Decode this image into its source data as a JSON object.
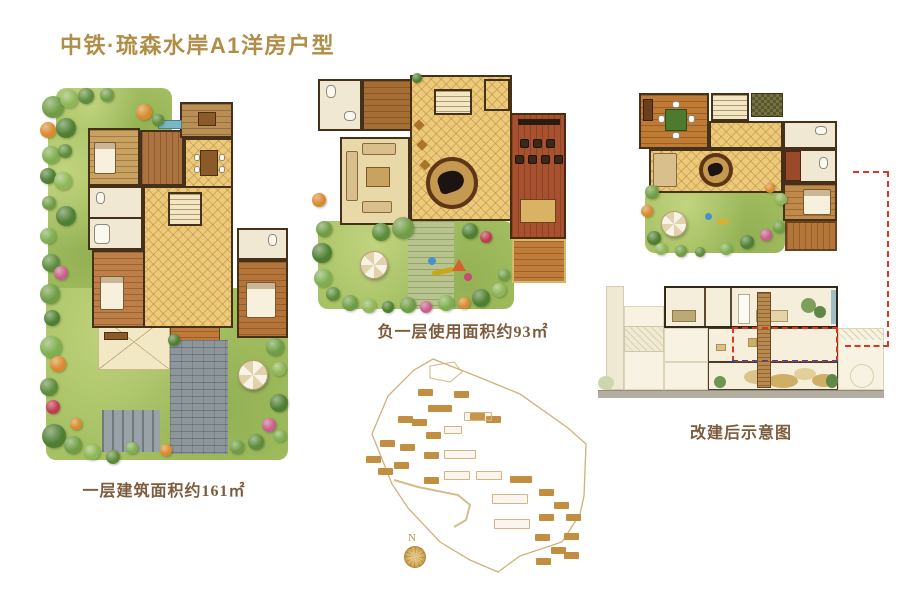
{
  "page": {
    "title": "中铁·琉森水岸A1洋房户型",
    "background": "#ffffff"
  },
  "plans": {
    "first_floor": {
      "caption": "一层建筑面积约161㎡"
    },
    "basement": {
      "caption": "负一层使用面积约93㎡"
    },
    "renovated_section": {
      "caption": "改建后示意图"
    }
  },
  "site_plan": {
    "compass_label": "N"
  },
  "colors": {
    "title_gold": "#b18e47",
    "caption_brown": "#7d5c3e",
    "highlight_red": "#e23320",
    "grass_green": "#a6c163",
    "tile_gold": "#ecca7a",
    "wood_brown": "#b5743a",
    "terracotta_wood": "#a85130",
    "paving_gray": "#8d969b",
    "wall_dark": "#453019",
    "site_gold": "#c28e3f"
  },
  "icons": [
    "tree-icon",
    "umbrella-icon",
    "compass-rose-icon",
    "piano-icon",
    "bed-icon",
    "sofa-icon",
    "stairs-icon"
  ]
}
